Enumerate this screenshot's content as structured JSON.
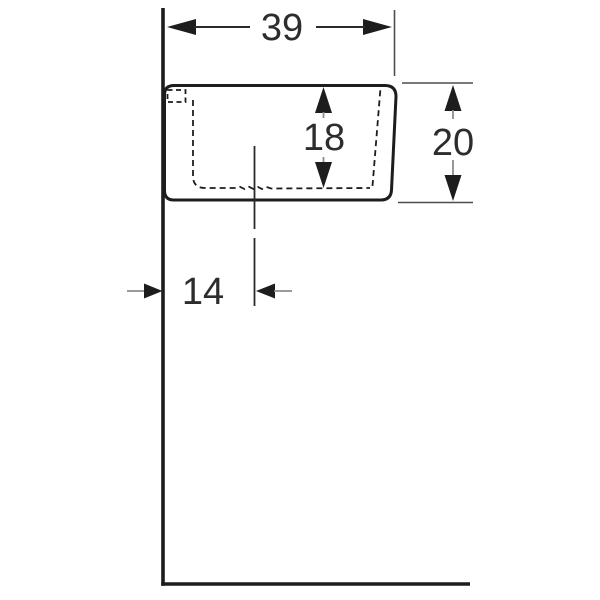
{
  "drawing": {
    "type": "technical-dimension-drawing",
    "subject": "wall-hung-washbasin-side-profile",
    "dims": {
      "width": "39",
      "basin_depth": "18",
      "height": "20",
      "drain_offset": "14"
    },
    "icons": {
      "arrowheads": "solid-triangle-dimension-arrows"
    },
    "colors": {
      "outline": "#1d1d1d",
      "text": "#2d2d2d",
      "extension_line": "#4d4d4d",
      "arrow_tail": "#8c8c8c",
      "background": "#ffffff"
    }
  }
}
